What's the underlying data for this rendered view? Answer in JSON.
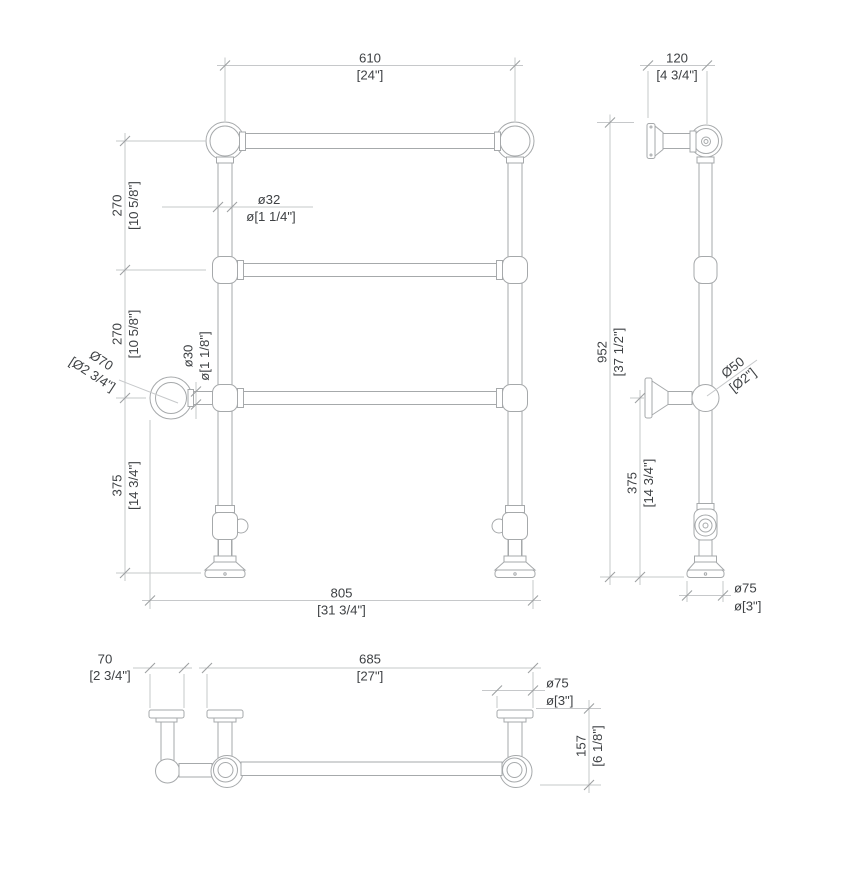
{
  "drawing": {
    "type": "towel-rail-technical-drawing",
    "units": "millimetres with inch equivalents in brackets"
  },
  "colors": {
    "background": "#ffffff",
    "object_line": "#a6a9ab",
    "dimension_line": "#c6c8ca",
    "tick": "#9da0a2",
    "text": "#3e4144"
  },
  "views": {
    "front": {
      "rail_width": {
        "mm": "610",
        "in": "[24\"]"
      },
      "upper_gap": {
        "mm": "270",
        "in": "[10 5/8\"]"
      },
      "lower_gap": {
        "mm": "270",
        "in": "[10 5/8\"]"
      },
      "base_height": {
        "mm": "375",
        "in": "[14 3/4\"]"
      },
      "overall_width": {
        "mm": "805",
        "in": "[31 3/4\"]"
      },
      "ring_diameter": {
        "mm": "Ø70",
        "in": "[Ø2 3/4\"]"
      },
      "post_diameter": {
        "mm": "ø32",
        "in": "ø[1 1/4\"]"
      },
      "rail_diameter": {
        "mm": "ø30",
        "in": "ø[1 1/8\"]"
      }
    },
    "side": {
      "bracket_depth": {
        "mm": "120",
        "in": "[4 3/4\"]"
      },
      "overall_height": {
        "mm": "952",
        "in": "[37 1/2\"]"
      },
      "ball_diameter": {
        "mm": "Ø50",
        "in": "[Ø2\"]"
      },
      "lower_bracket_height": {
        "mm": "375",
        "in": "[14 3/4\"]"
      },
      "foot_diameter": {
        "mm": "ø75",
        "in": "ø[3\"]"
      }
    },
    "top": {
      "ring_flange_width": {
        "mm": "70",
        "in": "[2 3/4\"]"
      },
      "bracket_span": {
        "mm": "685",
        "in": "[27\"]"
      },
      "flange_diameter": {
        "mm": "ø75",
        "in": "ø[3\"]"
      },
      "wall_depth": {
        "mm": "157",
        "in": "[6 1/8\"]"
      }
    }
  }
}
